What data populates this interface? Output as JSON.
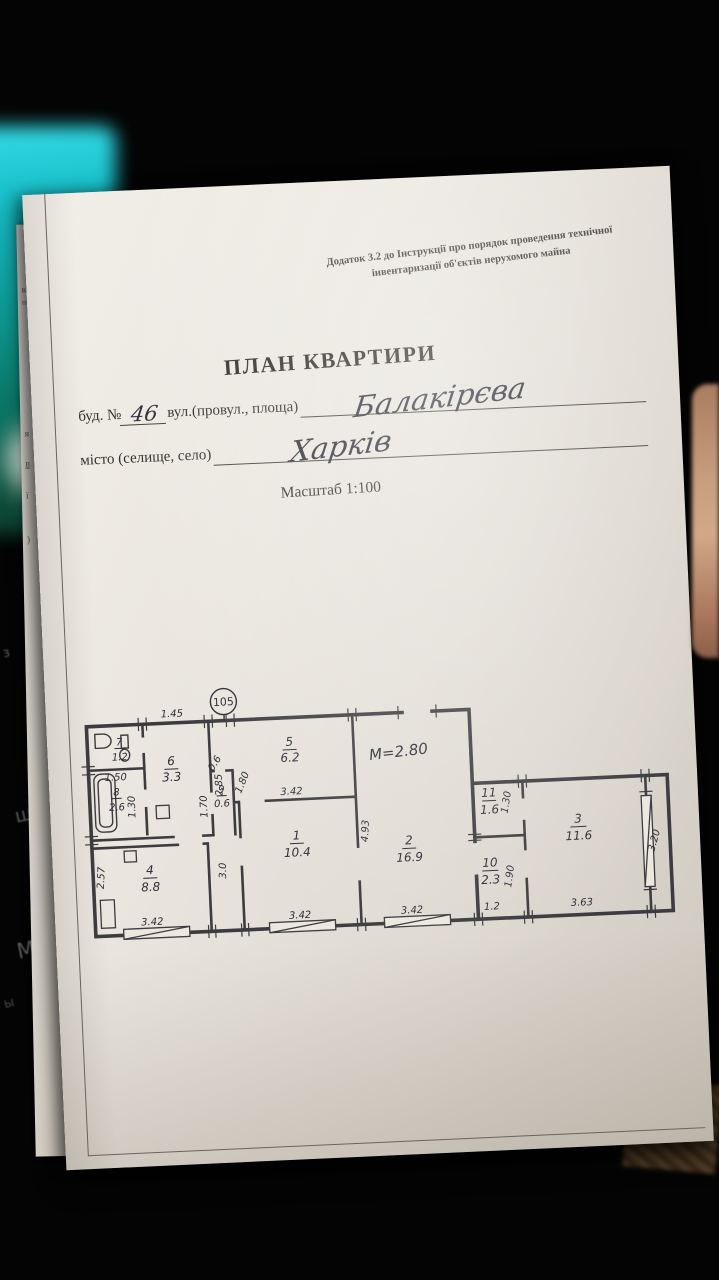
{
  "scene": {
    "keyboard_keys": [
      "з",
      "ш",
      "К",
      "М",
      "ы"
    ],
    "edge_text": [
      "кої",
      "ня",
      "я",
      "в",
      "ї",
      ")"
    ]
  },
  "form": {
    "appendix_note_line1": "Додаток 3.2 до Інструкції про порядок проведення технічної",
    "appendix_note_line2": "інвентаризації об'єктів нерухомого майна",
    "title": "ПЛАН КВАРТИРИ",
    "building_label": "буд. №",
    "building_value": "46",
    "street_label": "вул.(провул., площа)",
    "street_value": "Балакірєва",
    "city_label": "місто (селище, село)",
    "city_value": "Харків",
    "scale_label": "Масштаб 1:100"
  },
  "plan": {
    "apartment_number": "105",
    "height_note": "М=2.80",
    "rooms": [
      {
        "number": "1",
        "area": "10.4"
      },
      {
        "number": "2",
        "area": "16.9"
      },
      {
        "number": "3",
        "area": "11.6"
      },
      {
        "number": "4",
        "area": "8.8"
      },
      {
        "number": "5",
        "area": "6.2"
      },
      {
        "number": "6",
        "area": "3.3"
      },
      {
        "number": "7",
        "area": "1.2"
      },
      {
        "number": "8",
        "area": "2.6"
      },
      {
        "number": "9",
        "area": "0.6"
      },
      {
        "number": "10",
        "area": "2.3"
      },
      {
        "number": "11",
        "area": "1.6"
      }
    ],
    "dims": {
      "hall_top": "1.45",
      "wc_width": "1.50",
      "hall_side": "2.85",
      "bath_side": "1.70",
      "bath_width": "1.30",
      "closet_door": "0.6",
      "hall_opening": "1.80",
      "kitchen_width": "3.42",
      "room2_side": "4.93",
      "room2_width": "3.42",
      "room1_width": "3.42",
      "corridor_side": "3.0",
      "room4_width": "3.42",
      "room4_side": "2.57",
      "room11_side": "1.30",
      "room10_side": "1.90",
      "room10_width": "1.2",
      "room3_width": "3.63",
      "balcony_window": "3.20"
    }
  }
}
